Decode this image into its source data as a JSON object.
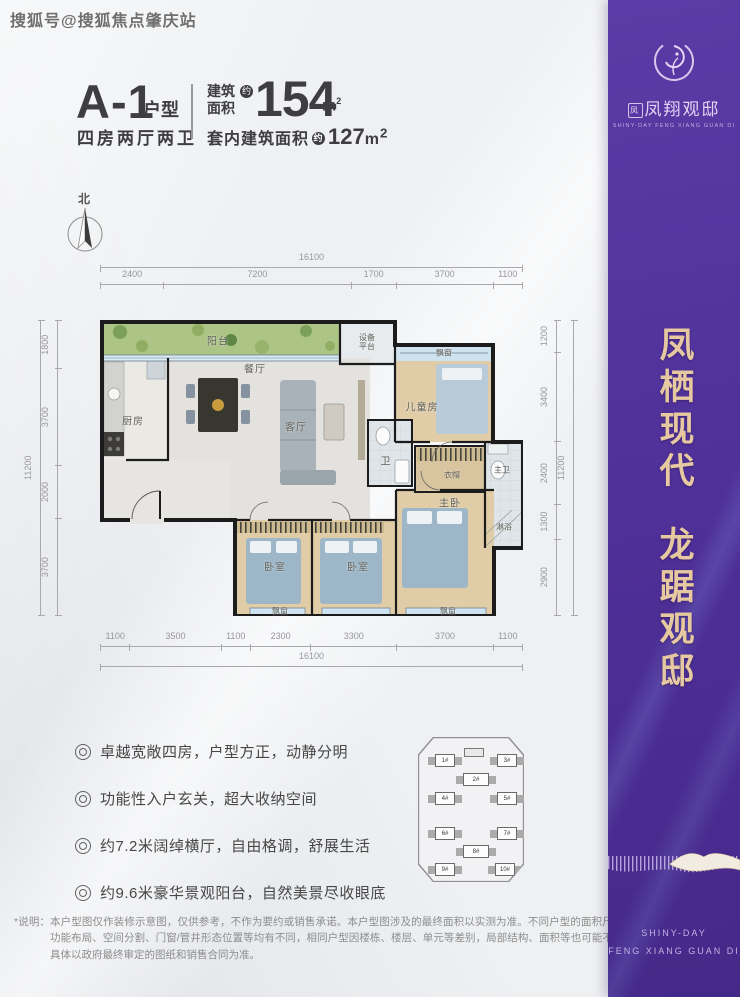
{
  "watermark": "搜狐号@搜狐焦点肇庆站",
  "header": {
    "unit_name": "A-1",
    "unit_type_suffix": "户型",
    "layout_desc": "四房两厅两卫",
    "gross_area": {
      "label_line1": "建筑",
      "label_line2": "面积",
      "approx": "约",
      "value": "154",
      "unit": "m",
      "unit_exp": "2"
    },
    "inner_area": {
      "label": "套内建筑面积",
      "approx": "约",
      "value": "127",
      "unit": "m",
      "unit_exp": "2"
    }
  },
  "compass": {
    "north": "北"
  },
  "plan": {
    "rooms": {
      "balcony": "阳台",
      "equipment_l1": "设备",
      "equipment_l2": "平台",
      "bay_top": "飘窗",
      "kitchen": "厨房",
      "dining": "餐厅",
      "living": "客厅",
      "bath": "卫",
      "kids": "儿童房",
      "cloak": "衣帽",
      "master_bath": "主卫",
      "shower": "淋浴",
      "master": "主卧",
      "bedroom_a": "卧室",
      "bedroom_b": "卧室",
      "bay_a": "飘窗",
      "bay_b": "飘窗"
    },
    "dims": {
      "top_total": "16100",
      "top": [
        "2400",
        "7200",
        "1700",
        "3700",
        "1100"
      ],
      "bottom": [
        "1100",
        "3500",
        "1100",
        "2300",
        "3300",
        "3700",
        "1100"
      ],
      "bottom_total": "16100",
      "left": [
        "1800",
        "3700",
        "2000",
        "3700"
      ],
      "left_total": "11200",
      "right": [
        "1200",
        "3400",
        "2400",
        "1300",
        "2900"
      ],
      "right_total": "11200"
    }
  },
  "features": [
    "卓越宽敞四房，户型方正，动静分明",
    "功能性入户玄关，超大收纳空间",
    "约7.2米阔绰横厅，自由格调，舒展生活",
    "约9.6米豪华景观阳台，自然美景尽收眼底"
  ],
  "sitemap": {
    "buildings": [
      "1#",
      "2#",
      "3#",
      "4#",
      "5#",
      "6#",
      "7#",
      "8#",
      "9#",
      "10#"
    ]
  },
  "banner": {
    "brand_seal": "凤",
    "brand_name": "凤翔观邸",
    "brand_tagline": "SHINY-DAY FENG XIANG GUAN DI",
    "slogan_1": "凤栖现代",
    "slogan_2": "龙踞观邸",
    "footer_en_1": "SHINY-DAY",
    "footer_en_2": "FENG XIANG GUAN DI"
  },
  "disclaimer": "*说明：本户型图仅作装修示意图，仅供参考，不作为要约或销售承诺。本户型图涉及的最终面积以实测为准。不同户型的面积尺寸、功能布局、空间分割、门窗/管井形态位置等均有不同，相同户型因楼栋、楼层、单元等差别，局部结构、面积等也可能不同，具体以政府最终审定的图纸和销售合同为准。",
  "colors": {
    "banner_purple": "#4f2f99",
    "accent_gold": "#e7c9a1",
    "title_dark": "#3e3e42"
  }
}
